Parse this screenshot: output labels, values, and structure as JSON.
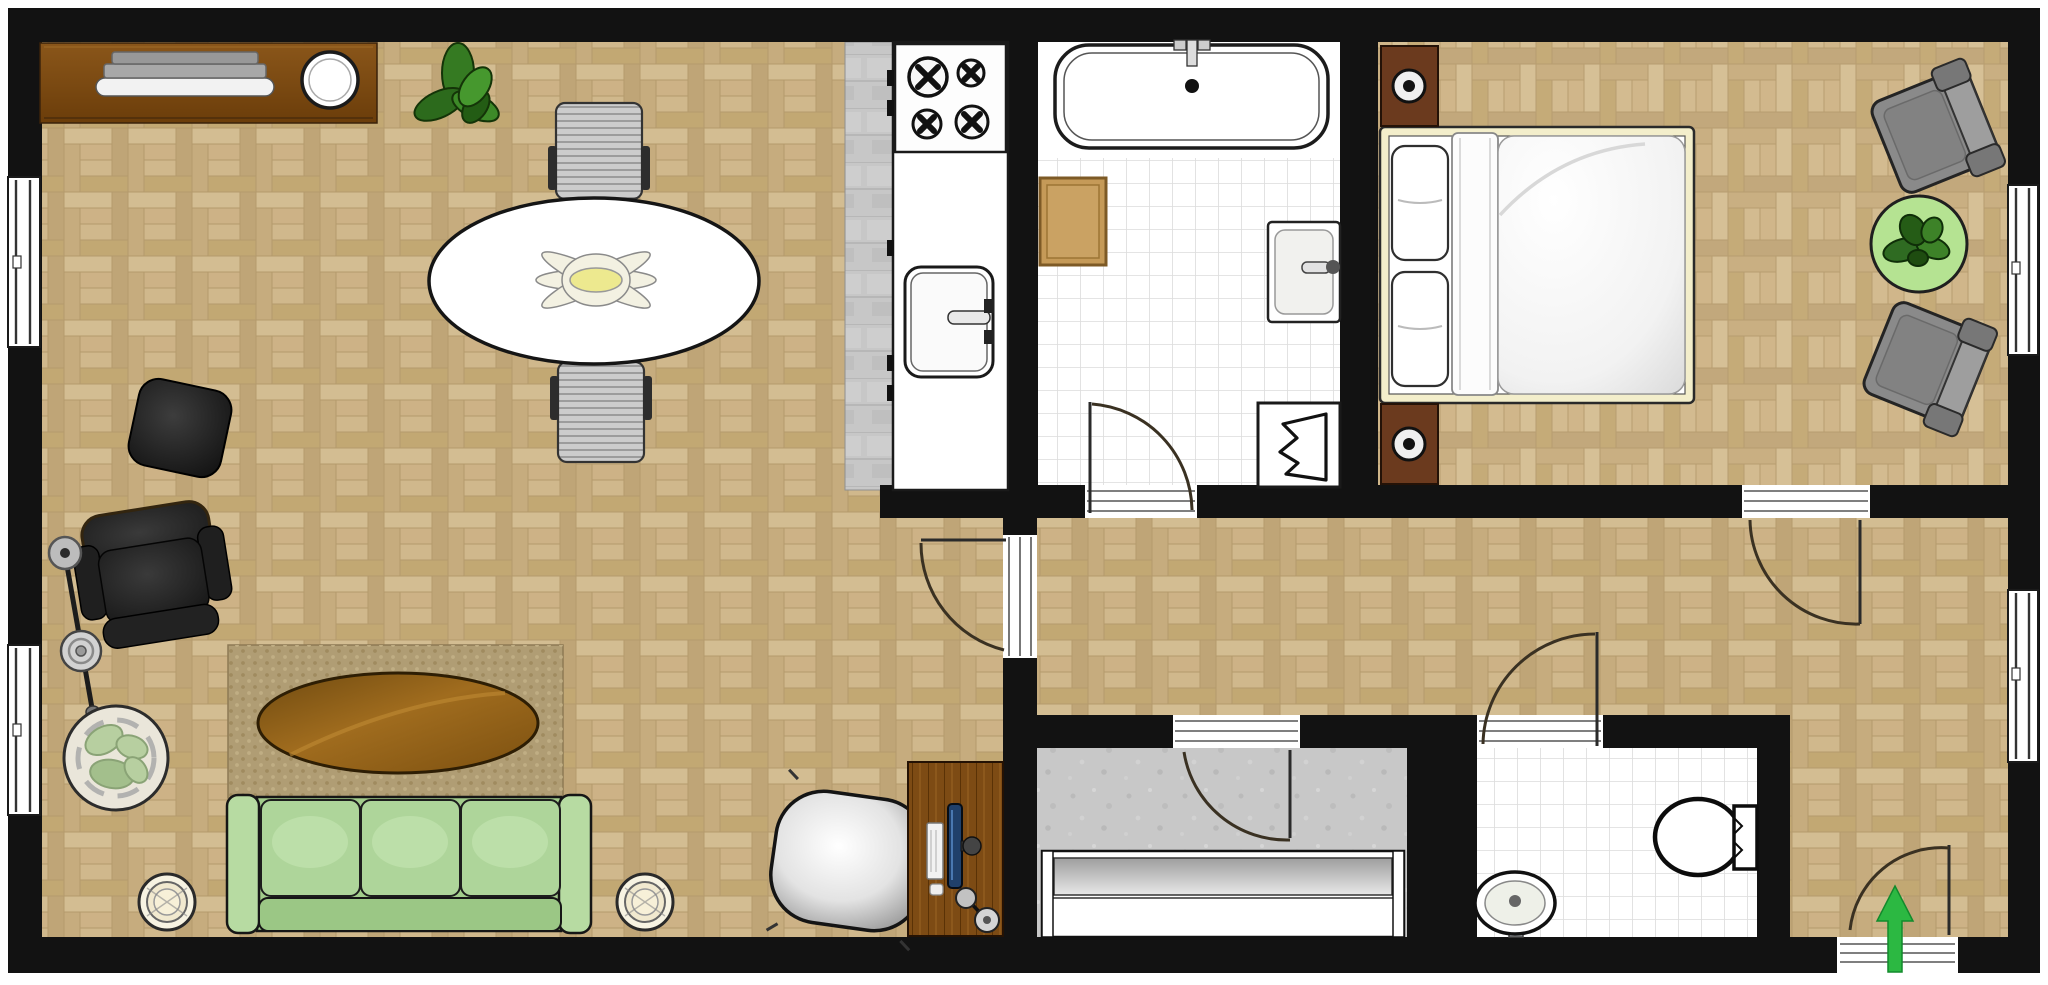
{
  "meta": {
    "kind": "apartment-floor-plan",
    "view": "top-down",
    "visible_text": []
  },
  "colors": {
    "wall": "#121212",
    "floor_parquet": "#c9b183",
    "floor_parquet_dark": "#b89a6c",
    "floor_tile_white": "#ffffff",
    "tile_grid": "#dcdcdc",
    "floor_kitchen_strip": "#c7c7c7",
    "floor_vestibule": "#c6c6c6",
    "rug": "#b09d74",
    "sofa": "#aed59a",
    "sofa_back": "#9bc785",
    "coffee_table": "#8a5a16",
    "dining_table": "#ffffff",
    "bed_frame": "#f3eecb",
    "bedroom_table": "#b5e392",
    "entrance_arrow": "#2cb842",
    "desk_wood": "#7d4b14",
    "sideboard_wood": "#7b4a12",
    "armchair_dark": "#242424",
    "armchair_gray": "#8a8a8a",
    "dining_chair": "#c9c9c9",
    "plant_dark": "#2f6b22",
    "plant_pale": "#b7cfa0",
    "bath_mat": "#c59a58",
    "nightstand": "#6b3a1e"
  },
  "rooms": [
    {
      "id": "living-dining",
      "floor": "parquet-herringbone",
      "furniture": [
        "sideboard",
        "serving-tray",
        "decorative-bowl",
        "potted-plant",
        "oval-dining-table",
        "dining-chair-top",
        "dining-chair-bottom",
        "table-centerpiece",
        "pouf",
        "lounge-armchair",
        "floor-lamp",
        "large-potted-plant",
        "area-rug",
        "oval-coffee-table",
        "three-seat-sofa",
        "round-side-table-left",
        "round-side-table-right",
        "desk-chair",
        "computer-desk",
        "monitor",
        "keyboard",
        "mouse",
        "desk-lamp"
      ]
    },
    {
      "id": "kitchen",
      "floor": "stone-tile-strip",
      "furniture": [
        "counter",
        "cooktop-4-burners",
        "kitchen-sink",
        "cabinet-handles"
      ]
    },
    {
      "id": "bathroom",
      "floor": "white-tile",
      "furniture": [
        "bathtub",
        "tub-faucet",
        "bath-mat",
        "washbasin",
        "laundry-basket"
      ]
    },
    {
      "id": "bedroom",
      "floor": "parquet-herringbone",
      "furniture": [
        "double-bed",
        "pillow-top",
        "pillow-bottom",
        "duvet",
        "nightstand-top",
        "nightstand-bottom",
        "table-lamp-top",
        "table-lamp-bottom",
        "armchair-top",
        "armchair-bottom",
        "round-plant-table"
      ]
    },
    {
      "id": "hallway",
      "floor": "parquet-herringbone",
      "furniture": []
    },
    {
      "id": "vestibule",
      "floor": "concrete",
      "furniture": [
        "wardrobe"
      ]
    },
    {
      "id": "wc",
      "floor": "white-tile",
      "furniture": [
        "toilet",
        "small-washbasin"
      ]
    }
  ],
  "openings": {
    "windows": [
      {
        "wall": "left",
        "room": "living-dining",
        "position": "upper"
      },
      {
        "wall": "left",
        "room": "living-dining",
        "position": "lower"
      },
      {
        "wall": "right",
        "room": "bedroom",
        "position": "upper"
      },
      {
        "wall": "right",
        "room": "hallway",
        "position": "lower"
      }
    ],
    "doors": [
      {
        "from": "living-dining",
        "to": "hallway",
        "swing": "into-living-room"
      },
      {
        "from": "hallway",
        "to": "bathroom",
        "swing": "into-bathroom"
      },
      {
        "from": "hallway",
        "to": "bedroom",
        "swing": "into-hallway"
      },
      {
        "from": "hallway",
        "to": "vestibule",
        "swing": "into-vestibule"
      },
      {
        "from": "hallway",
        "to": "wc",
        "swing": "into-hallway"
      },
      {
        "from": "outside",
        "to": "hallway",
        "type": "entrance",
        "swing": "into-hallway"
      }
    ],
    "entrance_arrow": {
      "direction": "up",
      "color": "#2cb842"
    }
  }
}
